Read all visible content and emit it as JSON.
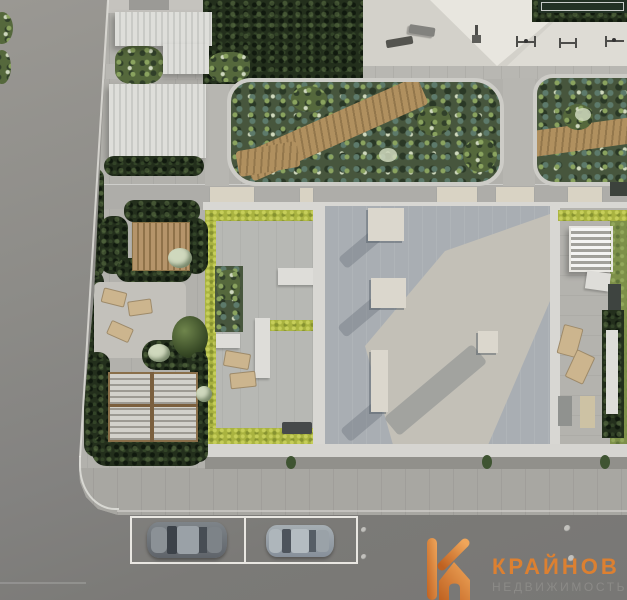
{
  "image": {
    "width": 627,
    "height": 600,
    "kind": "aerial 3D render of a residential complex courtyard"
  },
  "watermark": {
    "brand": "КРАЙНОВ",
    "subtitle": "НЕДВИЖИМОСТЬ",
    "brand_color": "#e0812f",
    "subtitle_color": "#8c8b88",
    "icon": "k-house-icon",
    "icon_gradient": [
      "#c2611e",
      "#f4a85a"
    ]
  },
  "palette": {
    "road_left": "#8c8b87",
    "road_bottom": "#7b7a77",
    "sidewalk": "#a8a7a2",
    "courtyard_paving": "#b2b1ac",
    "plaza": "#d3d1ca",
    "plaza_path": "#e8e6df",
    "canopy_white": "#d6d7d3",
    "trees_dark": "#232f1c",
    "shrub_green": "#55683c",
    "lime_hedge": "#a9b340",
    "lawn": "#7d9049",
    "deck_wood": "#a8895c",
    "roof_gray": "#a9aeb3",
    "roof_sunlit": "#c3c0b7",
    "parapet_white": "#d8d7d3",
    "skylight": "#dbd7cd",
    "parking_line": "#e9e7e2",
    "car_dark_silver": "#646a70",
    "car_light_silver": "#9aa3a9",
    "sports_court": "#223124"
  },
  "scene": {
    "elements": [
      "left asphalt road",
      "bottom road with parking bays",
      "two parked cars",
      "corner sidewalk with curved curb",
      "fitness plaza with benches and pull-up bars",
      "sports court corner with hedge",
      "white ribbed canopy roofs",
      "dense tree canopies",
      "organic-shaped planters with wooden decks",
      "apartment building flat roofs with skylights",
      "private terraces bordered by lime hedges",
      "wooden pergola",
      "white slatted pergola",
      "sun loungers",
      "lawn strips",
      "entrance pads",
      "manhole covers"
    ],
    "parking": {
      "spaces": 2,
      "cars": 2
    },
    "pergolas": 3,
    "planters": 2
  }
}
